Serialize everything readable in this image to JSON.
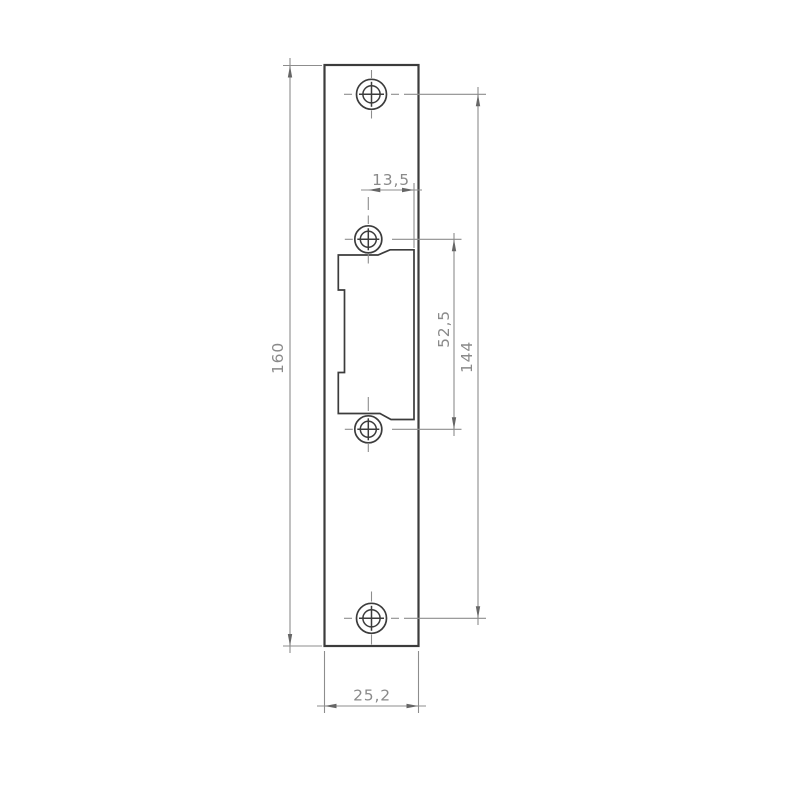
{
  "drawing": {
    "dimensions": {
      "plate_height": "160",
      "hole_to_cutout_edge": "13,5",
      "cutout_hole_spacing": "52,5",
      "outer_hole_spacing": "144",
      "plate_width": "25,2"
    },
    "colors": {
      "background": "#ffffff",
      "part_outline": "#3c3c3c",
      "dimension_lines": "#8d8d8d",
      "dimension_text": "#8a8a8a",
      "arrowheads": "#666666"
    }
  }
}
